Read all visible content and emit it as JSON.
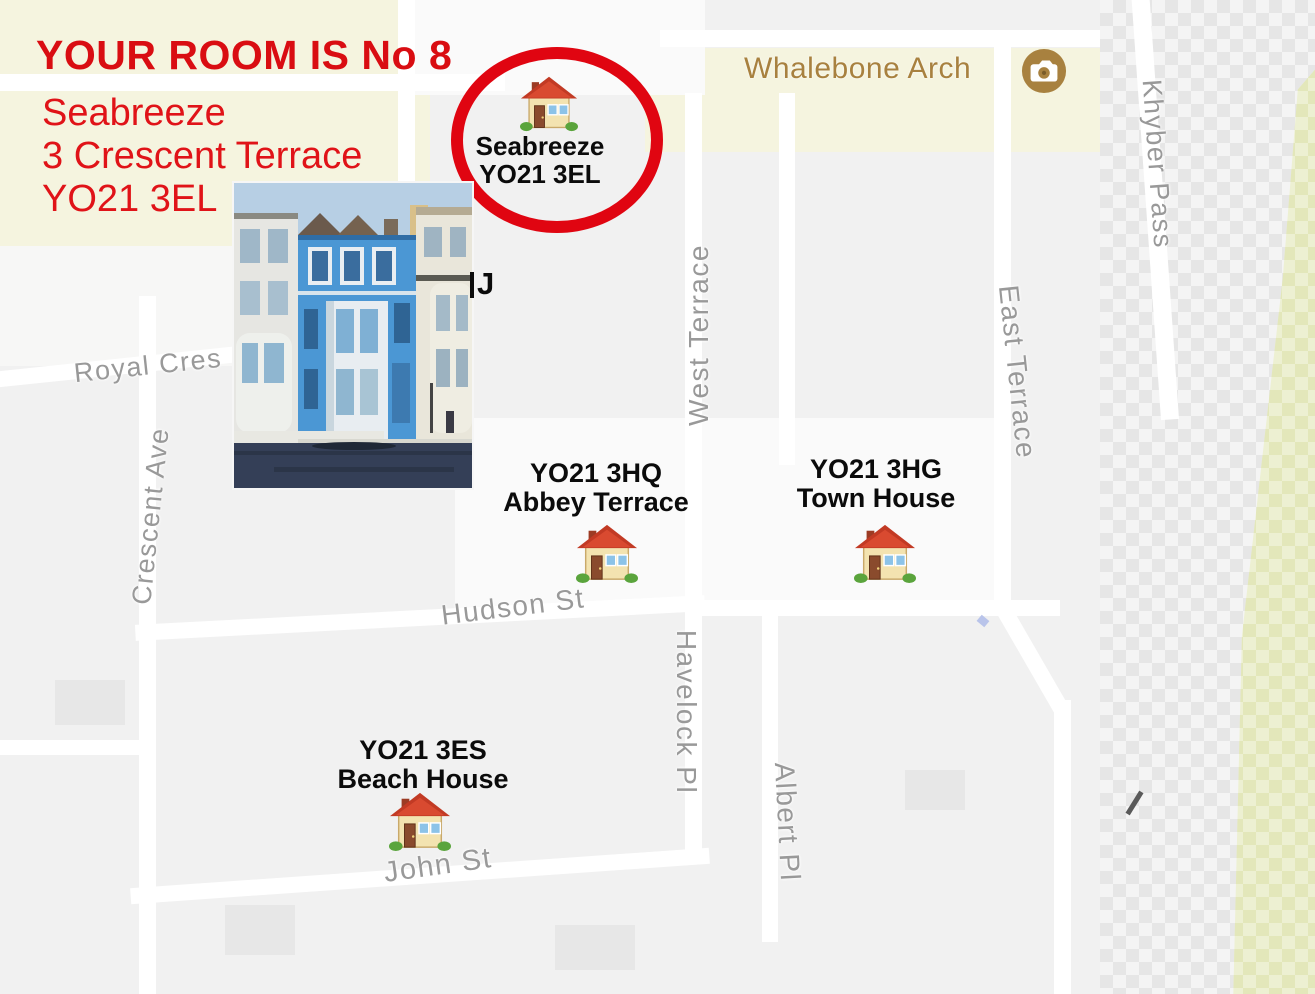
{
  "page": {
    "width": 1315,
    "height": 994,
    "kind": "annotated map directions"
  },
  "annotations": {
    "room_title": "YOUR ROOM IS No 8",
    "address_line1": "Seabreeze",
    "address_line2": "3 Crescent Terrace",
    "address_line3": "YO21 3EL",
    "hidden_label_fragment": "J",
    "accent_red": "#d90d12"
  },
  "markers": {
    "seabreeze": {
      "name": "Seabreeze",
      "postcode": "YO21 3EL"
    },
    "abbey_terrace": {
      "postcode": "YO21 3HQ",
      "name": "Abbey Terrace"
    },
    "town_house": {
      "postcode": "YO21 3HG",
      "name": "Town House"
    },
    "beach_house": {
      "postcode": "YO21 3ES",
      "name": "Beach House"
    }
  },
  "poi": {
    "whalebone_arch": {
      "label": "Whalebone Arch",
      "icon": "camera-icon",
      "color": "#a8813f"
    }
  },
  "streets": {
    "royal_cres": "Royal Cres",
    "crescent_ave": "Crescent Ave",
    "west_terrace": "West Terrace",
    "east_terrace": "East Terrace",
    "khyber_pass": "Khyber Pass",
    "hudson_st": "Hudson St",
    "havelock_pl": "Havelock Pl",
    "albert_pl": "Albert Pl",
    "john_st": "John St"
  },
  "map_colors": {
    "park": "#f5f4df",
    "green_area": "#edf0d2",
    "road": "#ffffff",
    "block": "#f1f1f1",
    "street_label": "#999999",
    "highlight_circle": "#e00511"
  }
}
